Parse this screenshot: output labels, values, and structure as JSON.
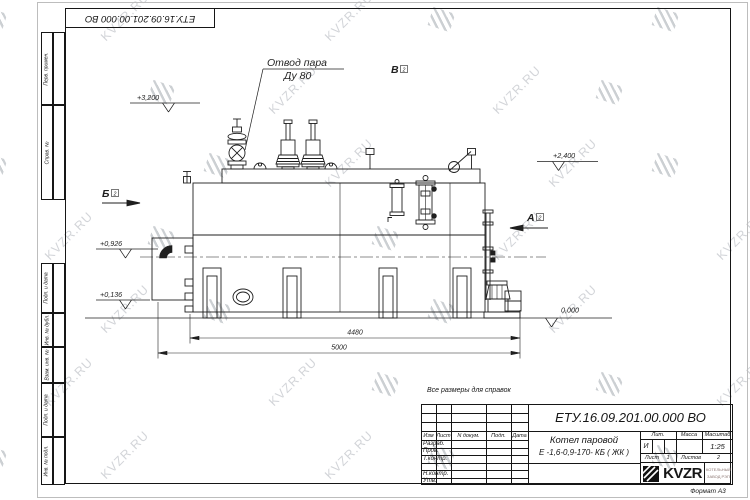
{
  "watermark": {
    "text": "KVZR.RU"
  },
  "frame": {
    "stamp_number_top": "ЕТУ.16.09.201.00.000  ВО",
    "margin_top": [
      "Перв. примен.",
      "Справ. №"
    ],
    "margin_bottom": [
      "Подп. и дата",
      "Инв. № дубл.",
      "Взам. инв. №",
      "Подп. и дата",
      "Инв. № подл."
    ],
    "format_label": "Формат А3"
  },
  "drawing": {
    "callout_line1": "Отвод пара",
    "callout_line2": "Ду 80",
    "views": {
      "a": "А",
      "b": "Б",
      "v": "В",
      "sheet_ref": "2"
    },
    "elevations": {
      "e3200": "+3,200",
      "e2400": "+2,400",
      "e0926": "+0,926",
      "e0136": "+0,136",
      "e0000": "0,000"
    },
    "dimensions": {
      "d4480": "4480",
      "d5000": "5000"
    }
  },
  "title_block": {
    "note": "Все размеры для справок",
    "doc_number": "ЕТУ.16.09.201.00.000  ВО",
    "name_line1": "Котел паровой",
    "name_line2": "Е -1,6-0,9-170- КБ ( ЖК )",
    "cols": [
      "Изм",
      "Лист",
      "N докум.",
      "Подп.",
      "Дата"
    ],
    "roles": [
      "Разраб.",
      "Пров.",
      "Т.контр.",
      "Н.контр.",
      "Утв."
    ],
    "lit_label": "Лит.",
    "mass_label": "Масса",
    "scale_label": "Масштаб",
    "lit_value": "И",
    "scale_value": "1:25",
    "sheet_label": "Лист",
    "sheet_value": "1",
    "sheets_label": "Листов",
    "sheets_value": "2",
    "logo": "KVZR",
    "logo_sub1": "КОТЕЛЬНЫЙ",
    "logo_sub2": "ЗАВОД РЭП"
  }
}
